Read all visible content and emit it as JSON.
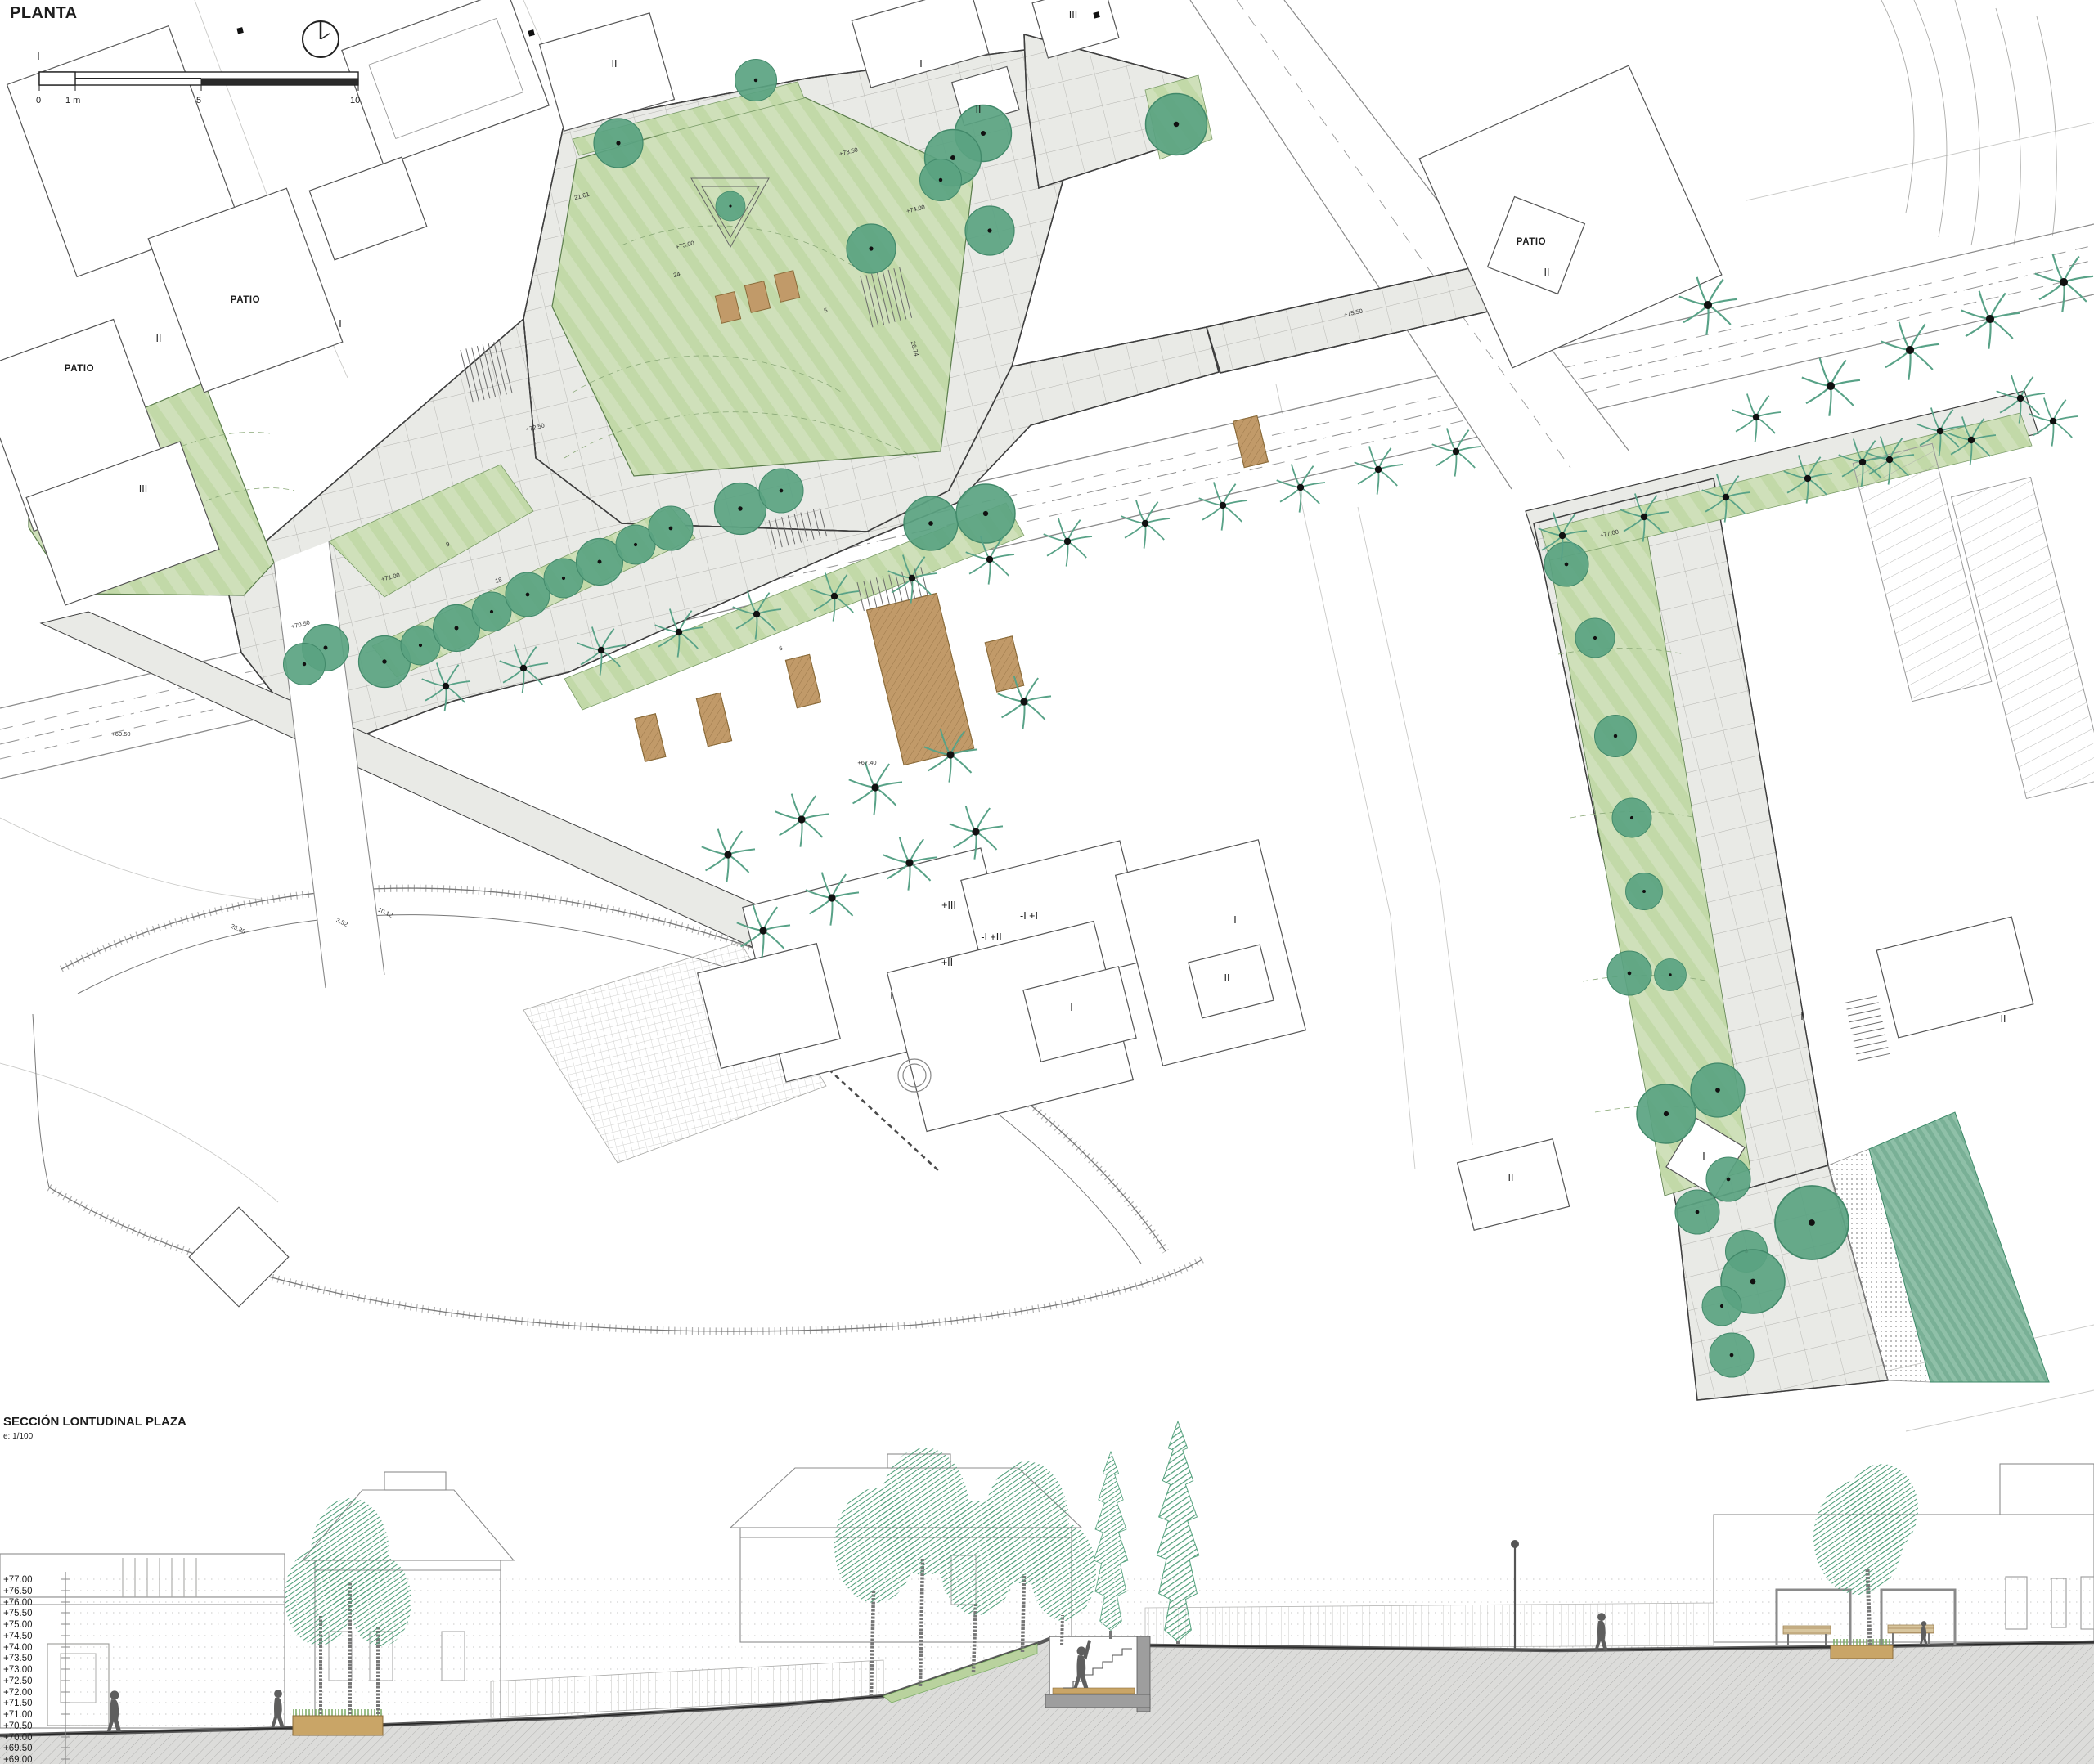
{
  "plan": {
    "title": "PLANTA",
    "scale_ticks": [
      "0",
      "1 m",
      "5",
      "10"
    ],
    "marks": [
      "I",
      "IV",
      "PATIO",
      "PATIO",
      "II",
      "III",
      "I",
      "II",
      "I",
      "II",
      "III",
      "PATIO",
      "II",
      "+III",
      "-I +I",
      "-I +II",
      "+II",
      "I",
      "I",
      "I",
      "II",
      "I",
      "I",
      "II",
      "II"
    ],
    "annotations": [
      "+73.50",
      "+73.00",
      "+74.00",
      "+72.50",
      "+71.00",
      "+70.50",
      "+75.50",
      "+77.00",
      "21.61",
      "24",
      "18",
      "9",
      "26.74",
      "23.88",
      "3.52",
      "10.12",
      "+69.50",
      "+67.40",
      "6",
      "5"
    ]
  },
  "section": {
    "title": "SECCIÓN LONTUDINAL PLAZA",
    "scale_note": "e: 1/100",
    "levels": [
      "+77.00",
      "+76.50",
      "+76.00",
      "+75.50",
      "+75.00",
      "+74.50",
      "+74.00",
      "+73.50",
      "+73.00",
      "+72.50",
      "+72.00",
      "+71.50",
      "+71.00",
      "+70.50",
      "+70.00",
      "+69.50",
      "+69.00"
    ]
  },
  "palette": {
    "paving": "#e9eae6",
    "lawn": "#cfe0ba",
    "lawn_stripe": "#c2d9a8",
    "tree": "#5aa381",
    "palm": "#58a287",
    "deck": "#c19a69",
    "teal_bank": "#74ad92",
    "ground_hatch": "#dcdcda",
    "figure": "#5e5e5e",
    "bench": "#d8c69e",
    "planter": "#c9a567",
    "outline": "#555555"
  }
}
